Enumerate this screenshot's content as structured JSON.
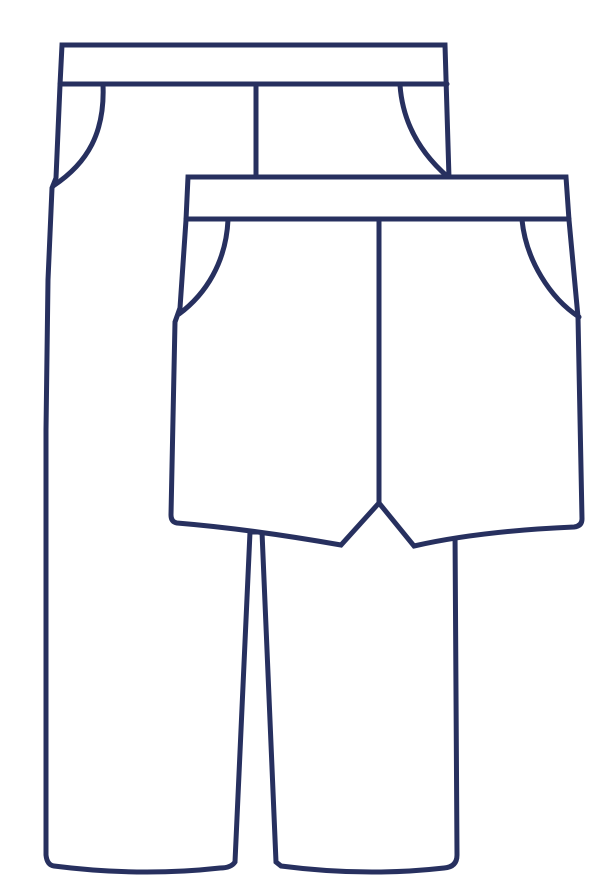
{
  "illustration": {
    "name": "pants-and-shorts-line-drawing",
    "description": "Outline line drawing of a pair of long pants shown behind an overlapping pair of shorts",
    "background_color": "#ffffff",
    "fill_color": "#ffffff",
    "line_color": "#27305f",
    "line_width": 5,
    "garments": [
      {
        "id": "pants",
        "label": "long pants"
      },
      {
        "id": "shorts",
        "label": "shorts"
      }
    ]
  },
  "paths": {
    "pants_outline": "M62,45 L445,45 L449,178 L455,530 L457,855 Q457,867 444,868 Q365,877 281,866 L276,862 L262,532 L250,532 L235,862 Q231,868 220,868 Q140,877 54,866 Q47,865 46,855 L46,430 L48,280 L52,188 L56,178 L60,85 Z",
    "pants_waistband_seam": "M60,84 L447,84",
    "pants_fly_seam": "M256,84 L256,179",
    "pants_left_pocket_seam": "M103,85 C105,132 88,163 53,186",
    "pants_right_pocket_seam": "M400,85 C403,128 425,157 448,177",
    "shorts_outline": "M188,177 L566,177 L569,220 L578,317 L582,519 Q582,526 574,527 Q480,531 414,546 L379,503 L341,545 Q250,529 177,523 Q171,522 171,515 L175,322 L180,308 L186,220 Z",
    "shorts_waistband_seam": "M186,219 L569,219",
    "shorts_fly_seam": "M379,219 L379,504",
    "shorts_left_pocket_seam": "M228,220 C226,262 206,294 179,314",
    "shorts_right_pocket_seam": "M522,220 C526,260 550,298 579,317"
  }
}
